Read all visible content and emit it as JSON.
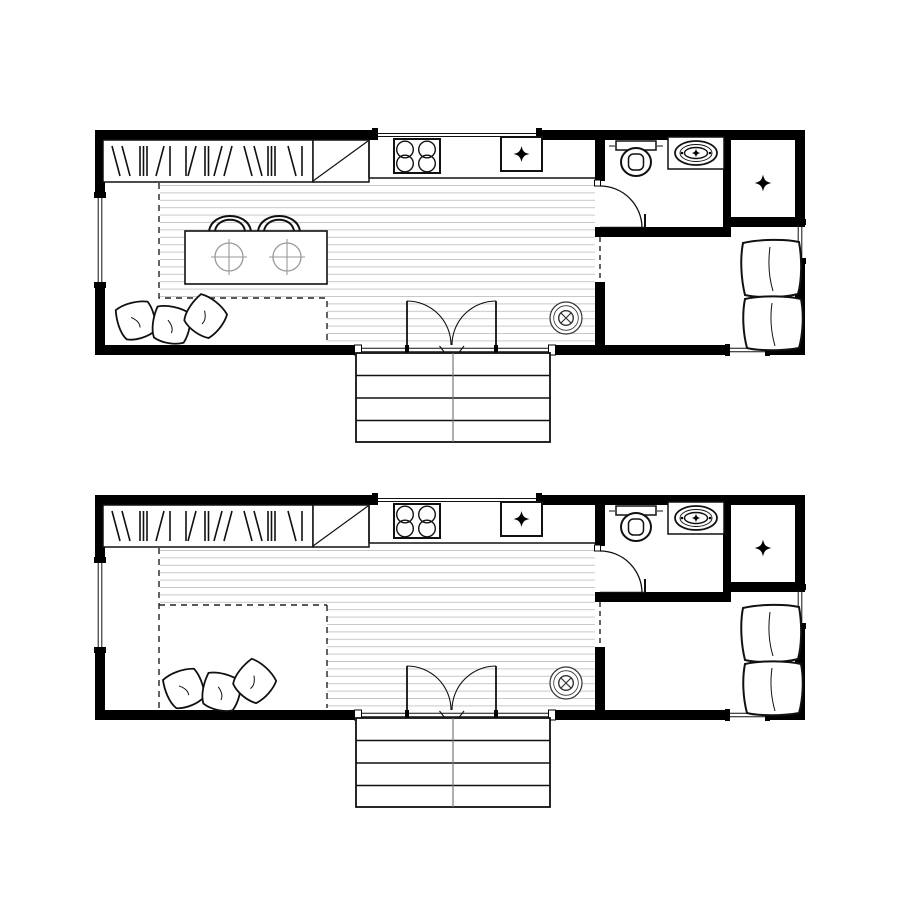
{
  "canvas": {
    "width": 900,
    "height": 900,
    "background": "#ffffff"
  },
  "colors": {
    "walls": "#000000",
    "outlines": "#111111",
    "floor_planks": "#c8c8c8",
    "dashed_boundary": "#222222",
    "tableware": "#999999",
    "vent_symbol": "#333333",
    "stair_center_line": "#777777"
  },
  "icons": {
    "closet_marker": "four-point-star",
    "appliance_marker": "four-point-star",
    "sink_faucet_marker": "four-point-star"
  },
  "plans": {
    "count": 2,
    "upper": "plan-with-dining-table-and-chairs",
    "lower": "plan-with-flex-area-and-floor-cushions"
  }
}
